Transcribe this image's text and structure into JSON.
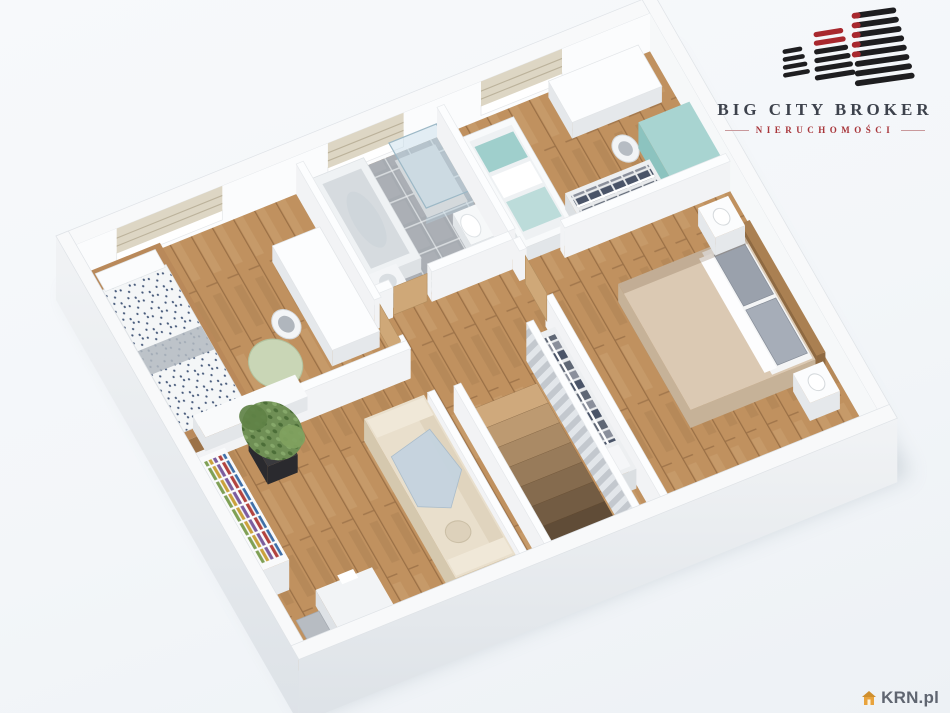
{
  "branding": {
    "logo_title": "BIG CITY BROKER",
    "logo_subtitle": "NIERUCHOMOŚCI"
  },
  "watermark": {
    "label": "KRN.pl"
  },
  "palette": {
    "background": "#f4f7f9",
    "wood_floor": "#c0915f",
    "bathroom_tile": "#a6abb1",
    "wall_top": "#f8f9fa",
    "wall_face": "#f2f3f5",
    "exterior_face": "#e8ebee",
    "accent_red": "#a8282e",
    "logo_text": "#3d424c",
    "subtitle_red": "#a8353a",
    "watermark_text": "#5f6570",
    "watermark_icon": "#e8a33d",
    "sofa_beige": "#e9dfcc",
    "blanket_blue": "#c5d3df",
    "bean_bag_green": "#c9d6b6",
    "nursery_teal": "#a8d4d1",
    "plant_green": "#6f8f55",
    "bed_beige": "#dbc9b3",
    "stair_wood": "#cfa97c",
    "door_wood": "#cfa878"
  }
}
